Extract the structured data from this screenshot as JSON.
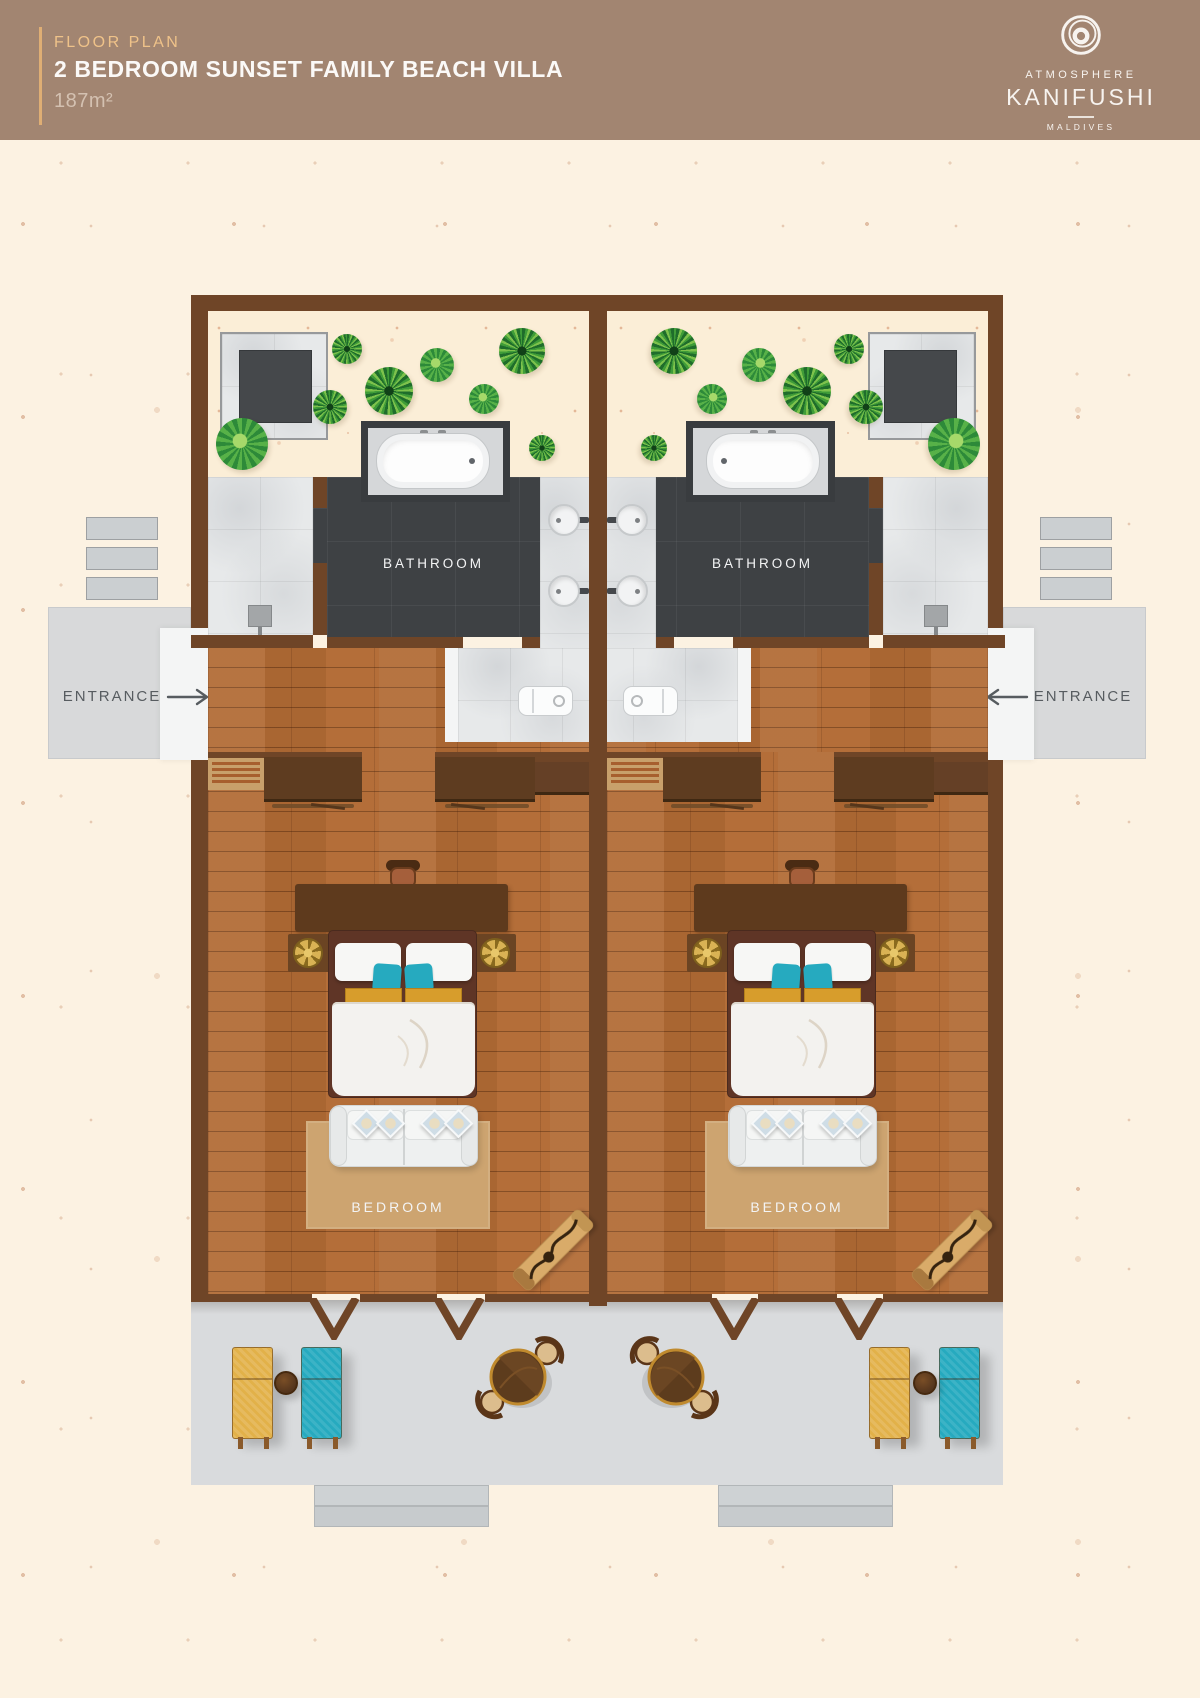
{
  "header": {
    "eyebrow": "FLOOR PLAN",
    "title": "2 BEDROOM SUNSET FAMILY BEACH VILLA",
    "area": "187m²",
    "logo": {
      "top": "ATMOSPHERE",
      "main": "KANIFUSHI",
      "sub": "MALDIVES"
    }
  },
  "plan": {
    "bathroom_label": "BATHROOM",
    "bedroom_label": "BEDROOM",
    "entrance_label": "ENTRANCE"
  },
  "colors": {
    "header_bg": "#a28571",
    "accent_gold": "#dfae74",
    "wall": "#6f4527",
    "wood": "#b26b35",
    "sand": "#fbeed7",
    "dark_bath": "#3e4144",
    "marble": "#e7e9ea",
    "deck": "#d9dbdd",
    "teal": "#26aabf",
    "lounger_yellow": "#e2b149",
    "rug": "#cda470"
  }
}
